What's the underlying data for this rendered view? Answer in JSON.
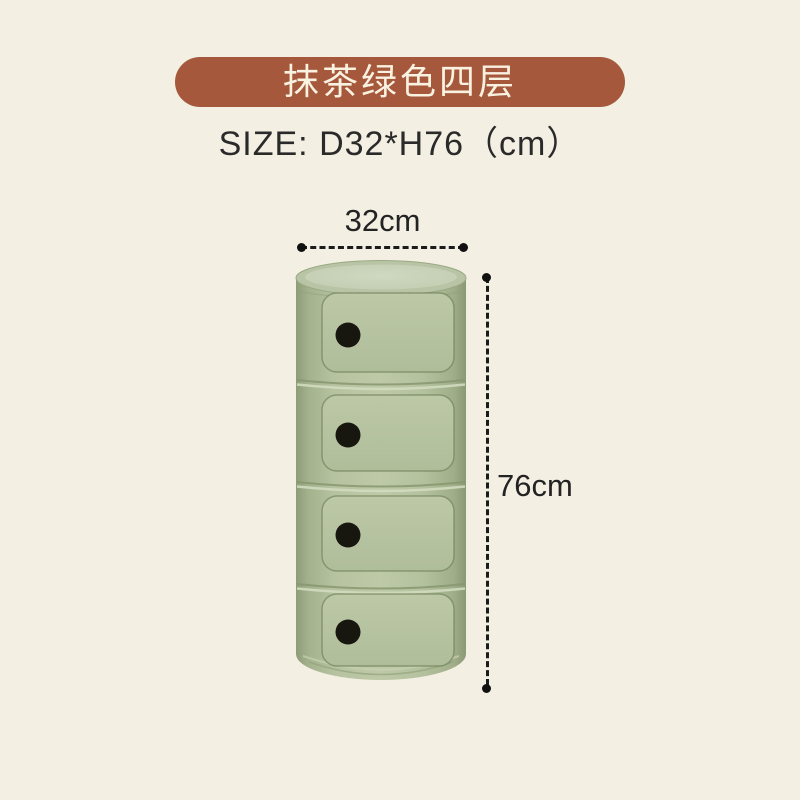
{
  "banner": {
    "label": "抹茶绿色四层"
  },
  "size_spec": {
    "label": "SIZE: D32*H76（cm）"
  },
  "dimensions": {
    "width": "32cm",
    "height": "76cm"
  },
  "product": {
    "drawer_count": 4
  },
  "colors": {
    "background": "#f4efe3",
    "banner_bg": "#a5583c",
    "banner_text": "#f9f2e0",
    "spec_text": "#2a2a2a",
    "dimension_lines": "#1b1b1b",
    "cabinet_green": "#b6c2a0",
    "cabinet_green_dark": "#8d9c77",
    "cabinet_lid": "#c7d1b8",
    "knob_black": "#17170f"
  }
}
